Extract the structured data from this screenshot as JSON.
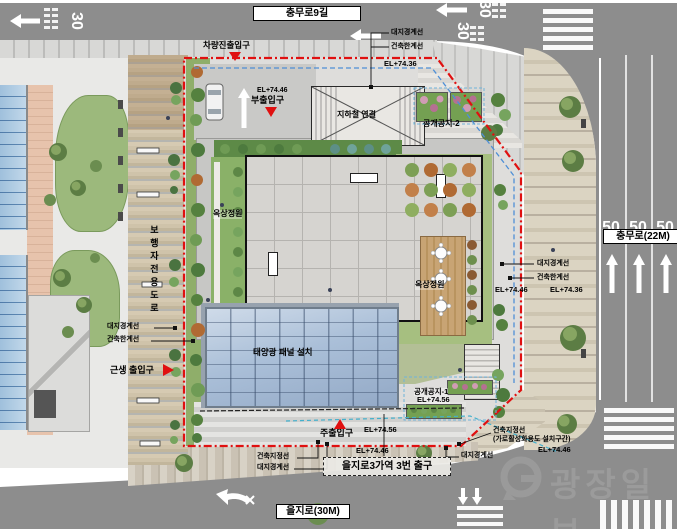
{
  "streets": {
    "top": {
      "name": "충무로9길",
      "speed_limit": "30"
    },
    "right": {
      "name": "충무로(22M)",
      "speed_limit": "50"
    },
    "bottom": {
      "name": "을지로(30M)"
    }
  },
  "site": {
    "entrances": {
      "vehicle": "차량진출입구",
      "sub": "부출입구",
      "main": "주출입구",
      "neighborhood": "근생 출입구"
    },
    "features": {
      "subway_link": "지하철 연결",
      "subway_exit": "을지로3가역 3번 출구",
      "open_space_1": "공개공지-1",
      "open_space_2": "공개공지-2",
      "rooftop_garden": "옥상정원",
      "pedestrian_road": "보행자전용도로",
      "solar_panel": "태양광 패널 설치"
    },
    "lines": {
      "site_boundary": "대지경계선",
      "building_limit": "건축한계선",
      "building_designation": "건축지정선",
      "street_activation": "(가로활성화용도 설치구간)"
    },
    "elevations": {
      "el_74_36": "EL+74.36",
      "el_74_46": "EL+74.46",
      "el_74_56": "EL+74.56"
    }
  },
  "watermark": {
    "text": "광장일보"
  },
  "colors": {
    "boundary_red": "#e01010",
    "limit_blue": "#4f8fd6",
    "designation_black": "#222222",
    "solar_blue": "#aabfd8",
    "lawn_green": "#8ab168",
    "road_grey": "#8d8d8d",
    "sidewalk_beige": "#d9d2c0"
  }
}
